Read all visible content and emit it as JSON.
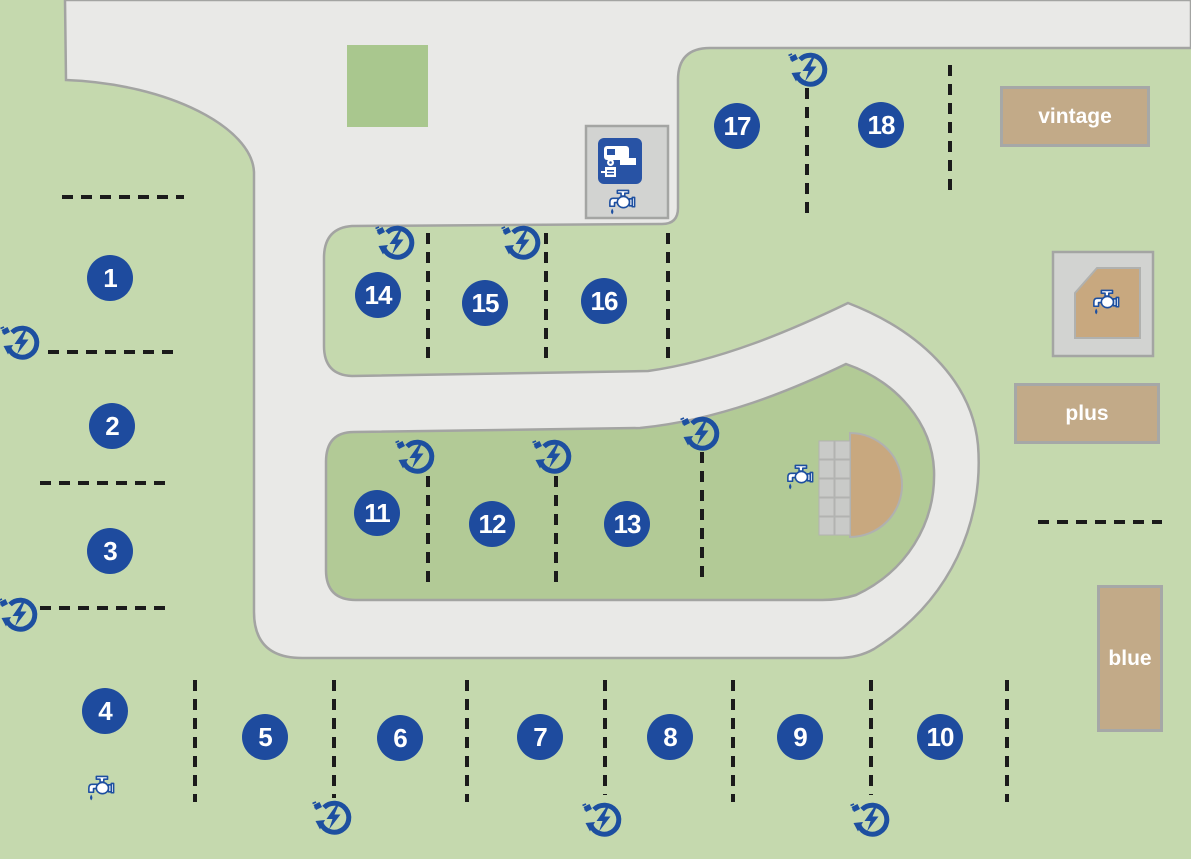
{
  "map_title": "campsite pitch map",
  "pitches": [
    "1",
    "2",
    "3",
    "4",
    "5",
    "6",
    "7",
    "8",
    "9",
    "10",
    "11",
    "12",
    "13",
    "14",
    "15",
    "16",
    "17",
    "18"
  ],
  "areas": {
    "vintage": "vintage",
    "plus": "plus",
    "blue": "blue"
  },
  "icons": {
    "electric_hookup": "electric-hookup",
    "water_tap": "water-tap",
    "motorhome_service": "motorhome-service-point"
  },
  "colors": {
    "ground": "#c5d9ae",
    "island": "#b2ca96",
    "patch": "#a9c78e",
    "road": "#e9e9e7",
    "road_border": "#a3a4a2",
    "accent_blue": "#1e4b9e",
    "icon_blue": "#1d4fa0",
    "tan": "#c2aa88",
    "tan_dark": "#c8a87f",
    "box_gray": "#d2d3d1",
    "label_border": "#a6a8a7",
    "dash": "#1b1b1b"
  }
}
